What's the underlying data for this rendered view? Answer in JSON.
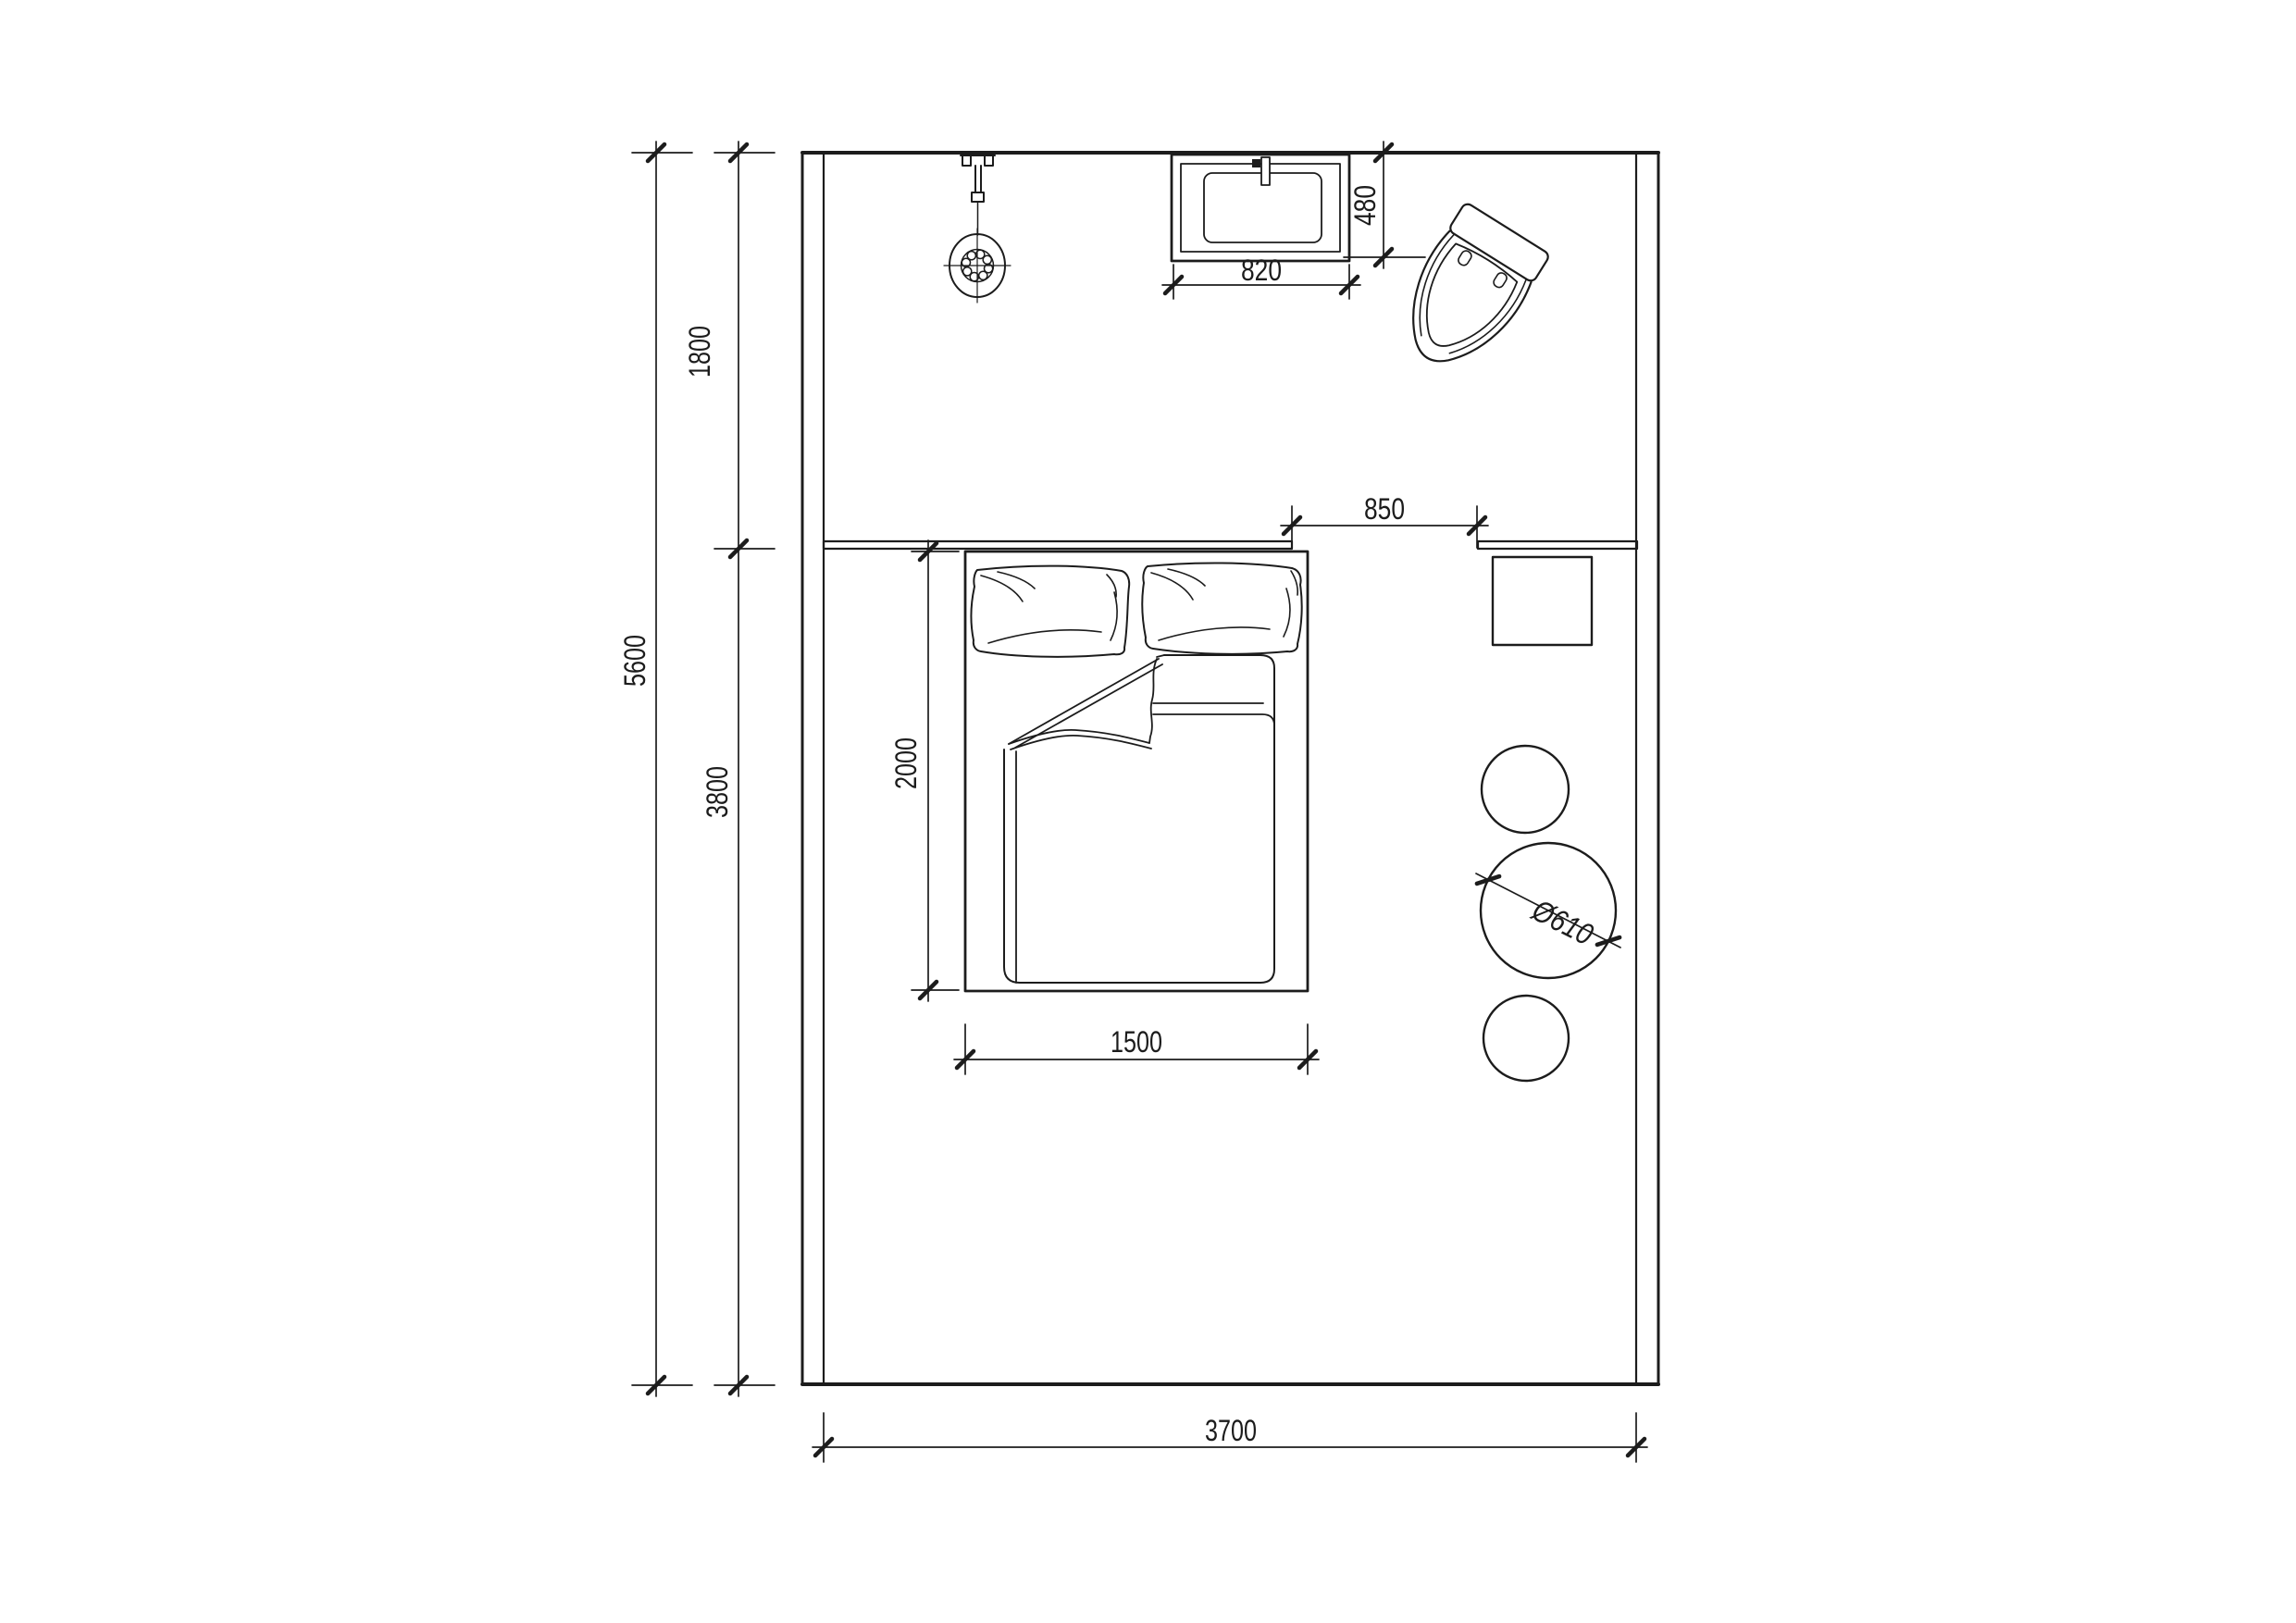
{
  "drawing": {
    "background": "#ffffff",
    "line_color": "#1c1c1c",
    "type": "bedroom-floor-plan"
  },
  "dims": {
    "height_total": "5600",
    "zone_top": "1800",
    "zone_bottom": "3800",
    "sink_depth": "480",
    "sink_width": "820",
    "opening": "850",
    "bed_length": "2000",
    "bed_width": "1500",
    "table_diameter": "Ø610",
    "room_width": "3700"
  },
  "fixtures": {
    "shower": "shower-head-icon",
    "sink": "washbasin-icon",
    "toilet": "toilet-icon",
    "bed": "double-bed-icon",
    "pillows": "pillow-icon",
    "blanket": "duvet-icon",
    "nightstand": "square-stool-icon",
    "table": "round-table-icon",
    "stools": "round-stool-icon"
  }
}
